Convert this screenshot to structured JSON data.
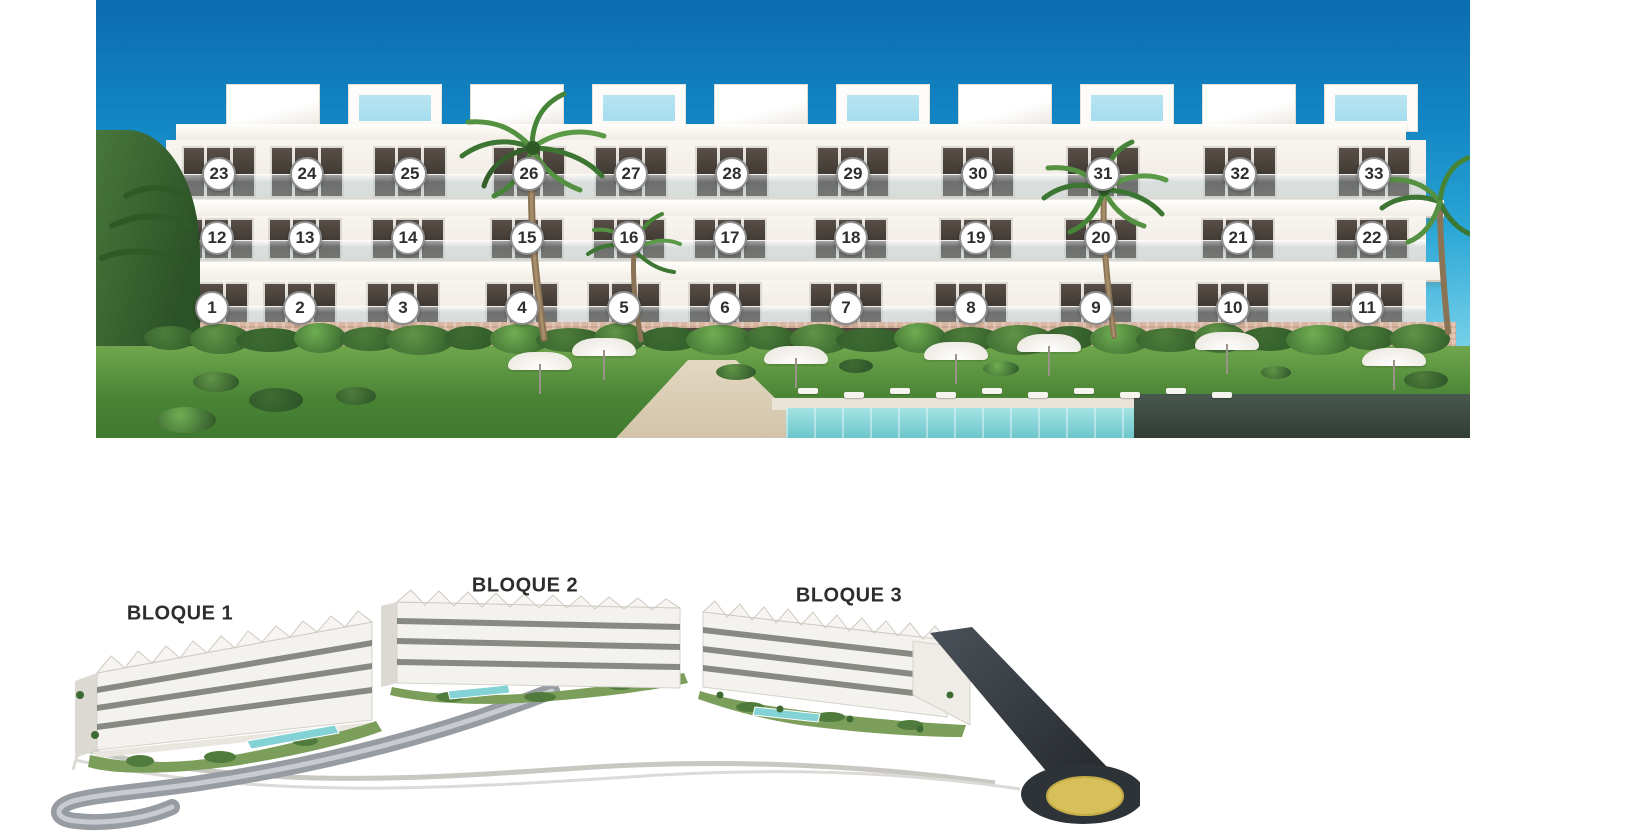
{
  "building_elevation": {
    "unit_rows": [
      [
        "23",
        "24",
        "25",
        "26",
        "27",
        "28",
        "29",
        "30",
        "31",
        "32",
        "33"
      ],
      [
        "12",
        "13",
        "14",
        "15",
        "16",
        "17",
        "18",
        "19",
        "20",
        "21",
        "22"
      ],
      [
        "1",
        "2",
        "3",
        "4",
        "5",
        "6",
        "7",
        "8",
        "9",
        "10",
        "11"
      ]
    ]
  },
  "site_plan": {
    "blocks": [
      {
        "label": "BLOQUE 1"
      },
      {
        "label": "BLOQUE 2"
      },
      {
        "label": "BLOQUE 3"
      }
    ]
  },
  "colors": {
    "sky_top": "#0c6cb0",
    "sky_light": "#8edcec",
    "facade_white": "#f8f4ef",
    "stone_base": "#d9b6a1",
    "lawn_green": "#5a9b3f",
    "pool_turquoise": "#7ecfd4",
    "marker_ring": "#8e8e8e",
    "marker_number": "#2e2e2e",
    "block_label": "#2d2d2d",
    "road_dark": "#3a4046",
    "roundabout_yellow": "#d7c05a"
  }
}
